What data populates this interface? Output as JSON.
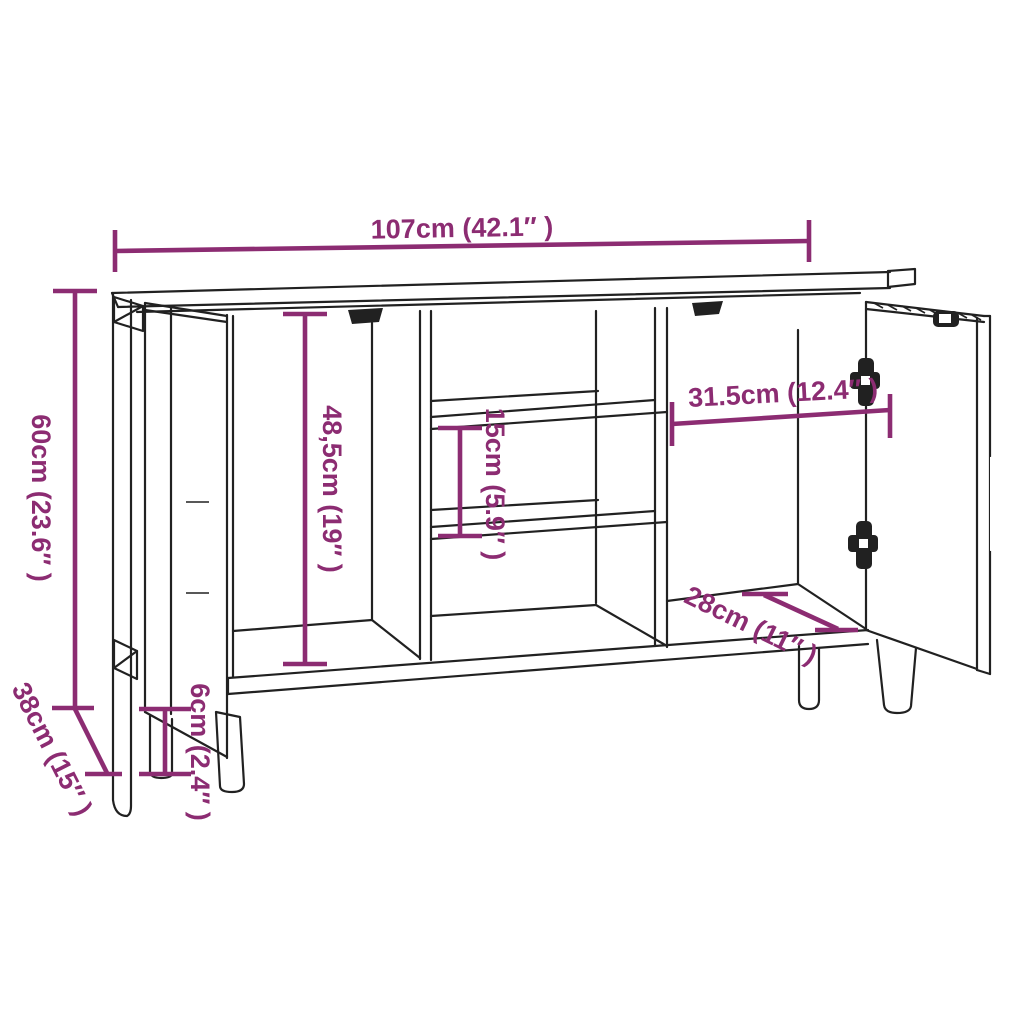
{
  "colors": {
    "accent": "#8c2c72",
    "ink": "#212121",
    "background": "#ffffff"
  },
  "diagram": {
    "type": "furniture-dimension-drawing",
    "subject": "sideboard line drawing with two open doors, three compartments, two middle shelves and four legs",
    "dimensions": {
      "overall_width": "107cm (42.1″ )",
      "overall_height": "60cm (23.6″ )",
      "overall_depth": "38cm (15″ )",
      "door_compartment_height": "48,5cm (19″ )",
      "shelf_spacing": "15cm (5.9″ )",
      "middle_compartment_width": "31.5cm (12.4″ )",
      "compartment_depth": "28cm (11″ )",
      "leg_height": "6cm (2.4″ )"
    }
  }
}
